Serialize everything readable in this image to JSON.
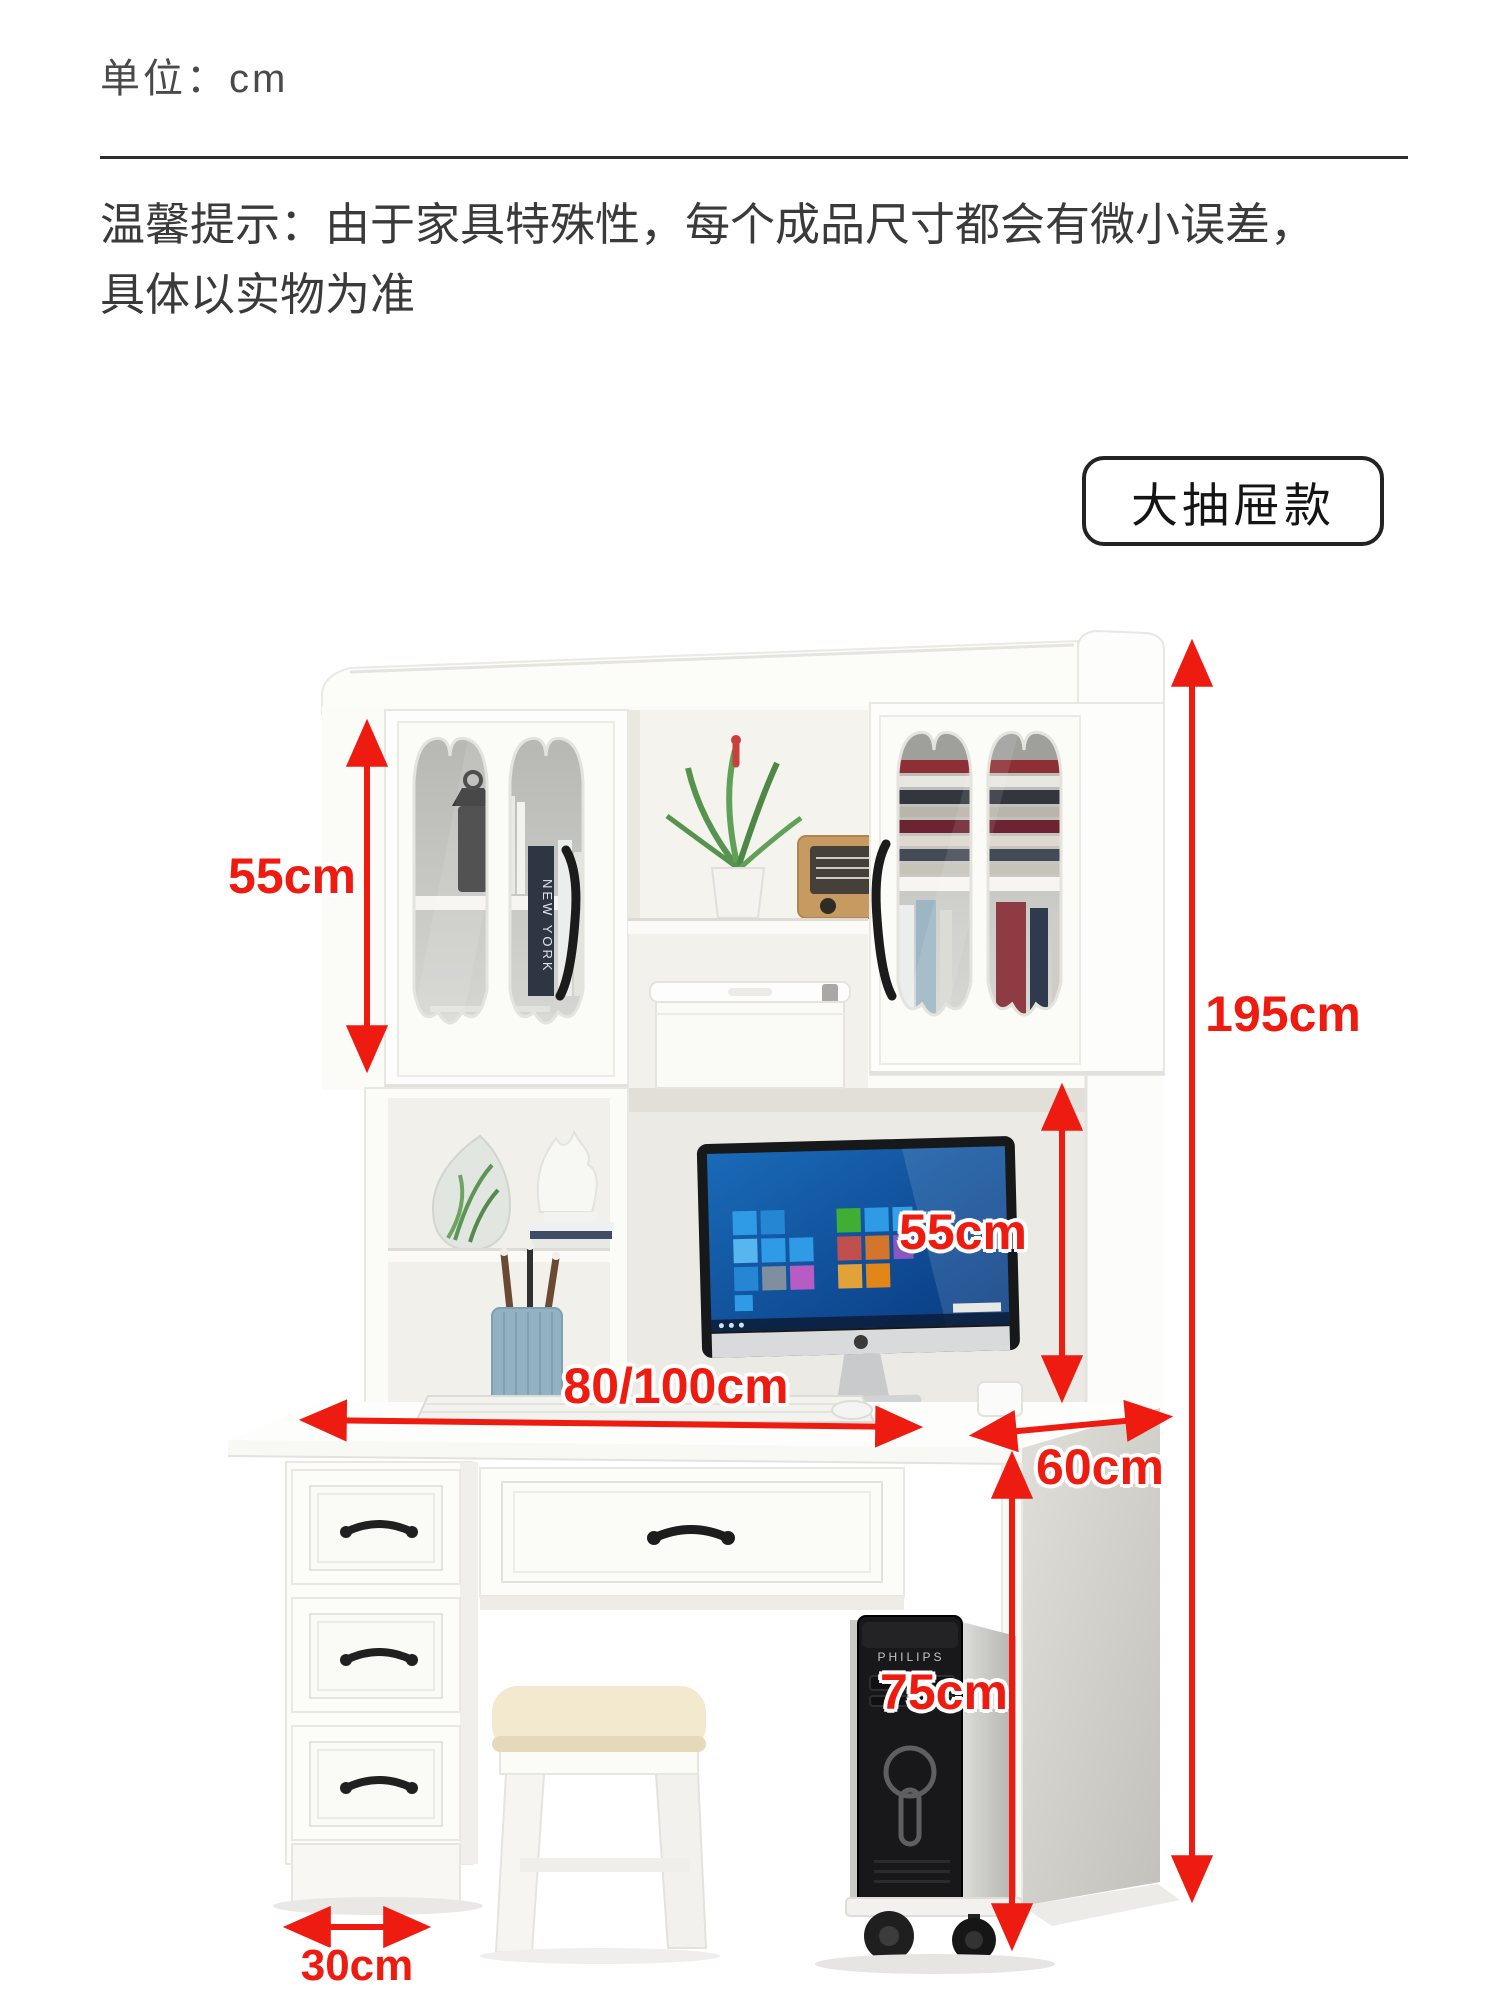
{
  "header": {
    "unit_label": "单位：cm",
    "notice_line1": "温馨提示：由于家具特殊性，每个成品尺寸都会有微小误差，",
    "notice_line2": "具体以实物为准",
    "variant_badge": "大抽屉款"
  },
  "dimensions": {
    "left_cabinet_height": "55cm",
    "monitor_space_height": "55cm",
    "total_height": "195cm",
    "desk_width": "80/100cm",
    "desk_depth": "60cm",
    "desk_height": "75cm",
    "pedestal_width": "30cm"
  },
  "furniture_text": {
    "pc_brand": "PHILIPS",
    "book_spine": "NEW YORK"
  },
  "colors": {
    "dimension_red": "#ee1b10",
    "notice_text": "#3a3a3a",
    "furniture_white": "#fbfbf8"
  }
}
